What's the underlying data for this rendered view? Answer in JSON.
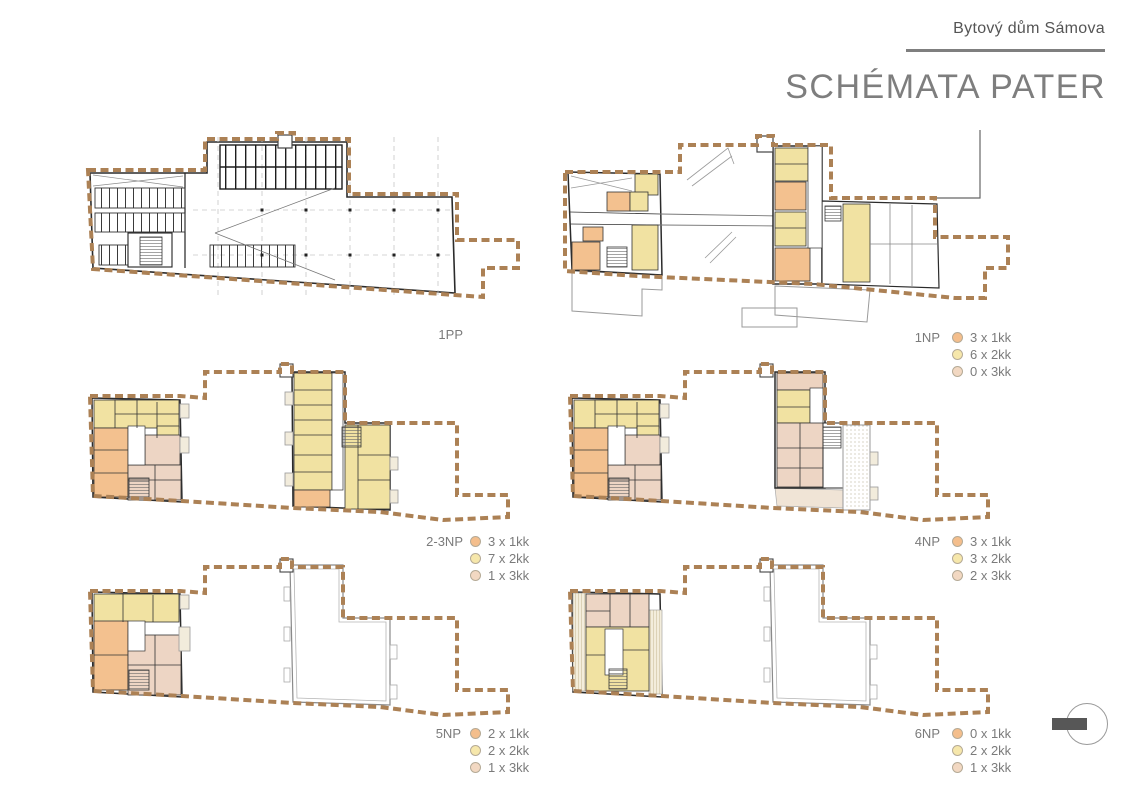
{
  "header": {
    "project_name": "Bytový dům Sámova",
    "sheet_title": "SCHÉMATA PATER"
  },
  "colors": {
    "1kk": "#F4BE8C",
    "2kk": "#F6E7AB",
    "3kk": "#F2D8C2",
    "boundary": "#AC8155"
  },
  "plans": [
    {
      "label": "1PP",
      "legend": []
    },
    {
      "label": "1NP",
      "legend": [
        {
          "unit": "1kk",
          "text": "3 x 1kk"
        },
        {
          "unit": "2kk",
          "text": "6 x 2kk"
        },
        {
          "unit": "3kk",
          "text": "0 x 3kk"
        }
      ]
    },
    {
      "label": "2-3NP",
      "legend": [
        {
          "unit": "1kk",
          "text": "3 x 1kk"
        },
        {
          "unit": "2kk",
          "text": "7 x 2kk"
        },
        {
          "unit": "3kk",
          "text": "1 x 3kk"
        }
      ]
    },
    {
      "label": "4NP",
      "legend": [
        {
          "unit": "1kk",
          "text": "3 x 1kk"
        },
        {
          "unit": "2kk",
          "text": "3 x 2kk"
        },
        {
          "unit": "3kk",
          "text": "2 x 3kk"
        }
      ]
    },
    {
      "label": "5NP",
      "legend": [
        {
          "unit": "1kk",
          "text": "2 x 1kk"
        },
        {
          "unit": "2kk",
          "text": "2 x 2kk"
        },
        {
          "unit": "3kk",
          "text": "1 x 3kk"
        }
      ]
    },
    {
      "label": "6NP",
      "legend": [
        {
          "unit": "1kk",
          "text": "0 x 1kk"
        },
        {
          "unit": "2kk",
          "text": "2 x 2kk"
        },
        {
          "unit": "3kk",
          "text": "1 x 3kk"
        }
      ]
    }
  ]
}
